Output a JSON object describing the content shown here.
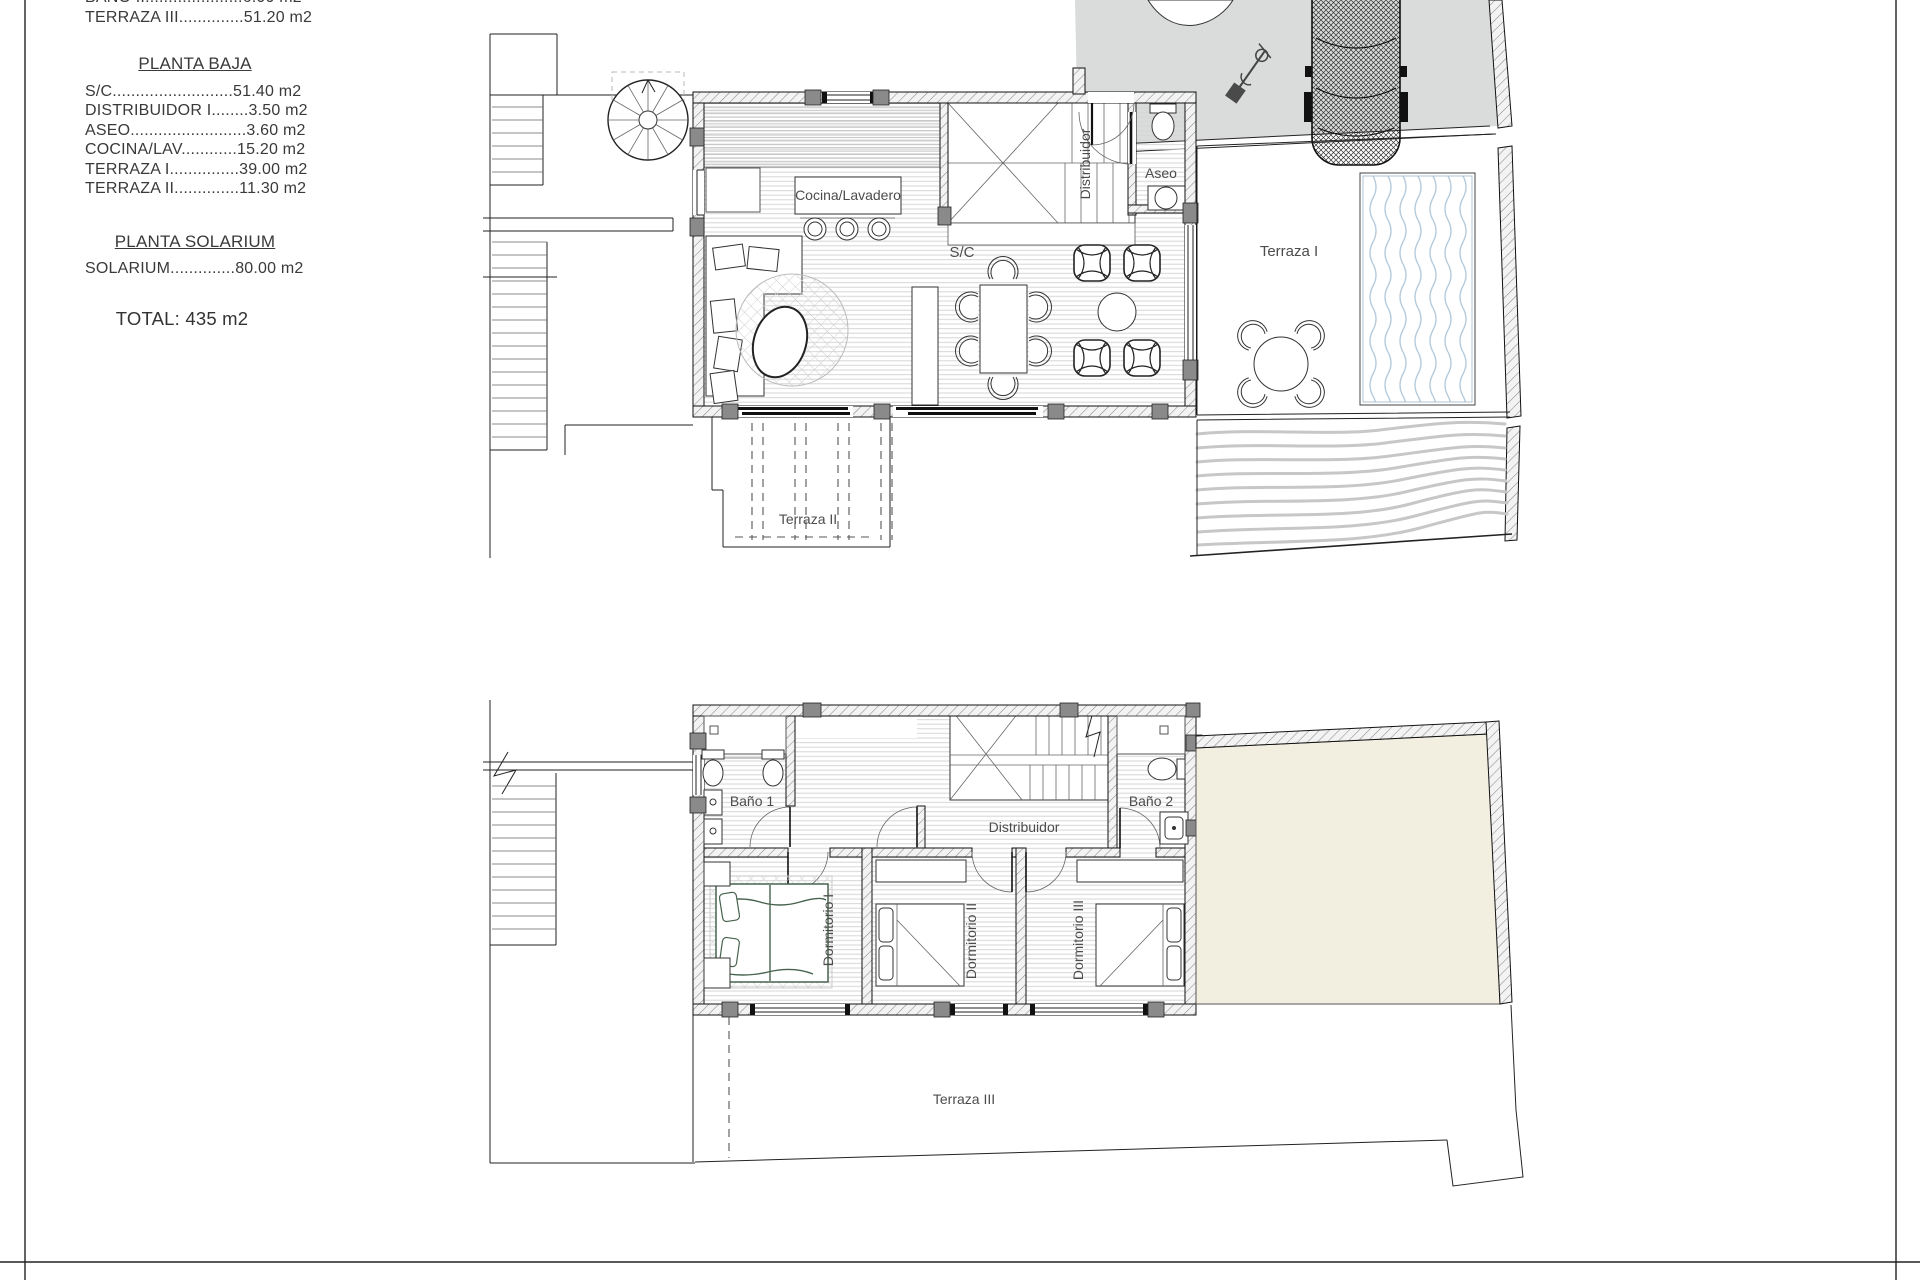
{
  "legend": {
    "clipped_top": [
      "BAÑO II.....................6.00 m2",
      "TERRAZA III..............51.20 m2"
    ],
    "planta_baja_title": "PLANTA BAJA",
    "planta_baja_items": [
      "S/C..........................51.40 m2",
      "DISTRIBUIDOR I........3.50 m2",
      "ASEO.........................3.60 m2",
      "COCINA/LAV............15.20 m2",
      "TERRAZA I...............39.00 m2",
      "TERRAZA II..............11.30 m2"
    ],
    "planta_solarium_title": "PLANTA SOLARIUM",
    "planta_solarium_items": [
      "SOLARIUM..............80.00 m2"
    ],
    "total": "TOTAL: 435 m2"
  },
  "ground_floor": {
    "labels": {
      "cocina": "Cocina/Lavadero",
      "sc": "S/C",
      "distribuidor": "Distribuidor",
      "aseo": "Aseo",
      "terraza1": "Terraza I",
      "terraza2": "Terraza II"
    }
  },
  "first_floor": {
    "labels": {
      "bano1": "Baño 1",
      "bano2": "Baño 2",
      "distribuidor": "Distribuidor",
      "dormitorio1": "Dormitorio I",
      "dormitorio2": "Dormitorio II",
      "dormitorio3": "Dormitorio III",
      "terraza3": "Terraza III"
    }
  },
  "colors": {
    "driveway": "#d9dcda",
    "solarium_beige": "#f2eee0",
    "pool_water": "#b5cbdc",
    "contour": "#c7c7c7",
    "wall_pier": "#8a8a8a",
    "line": "#222222"
  }
}
